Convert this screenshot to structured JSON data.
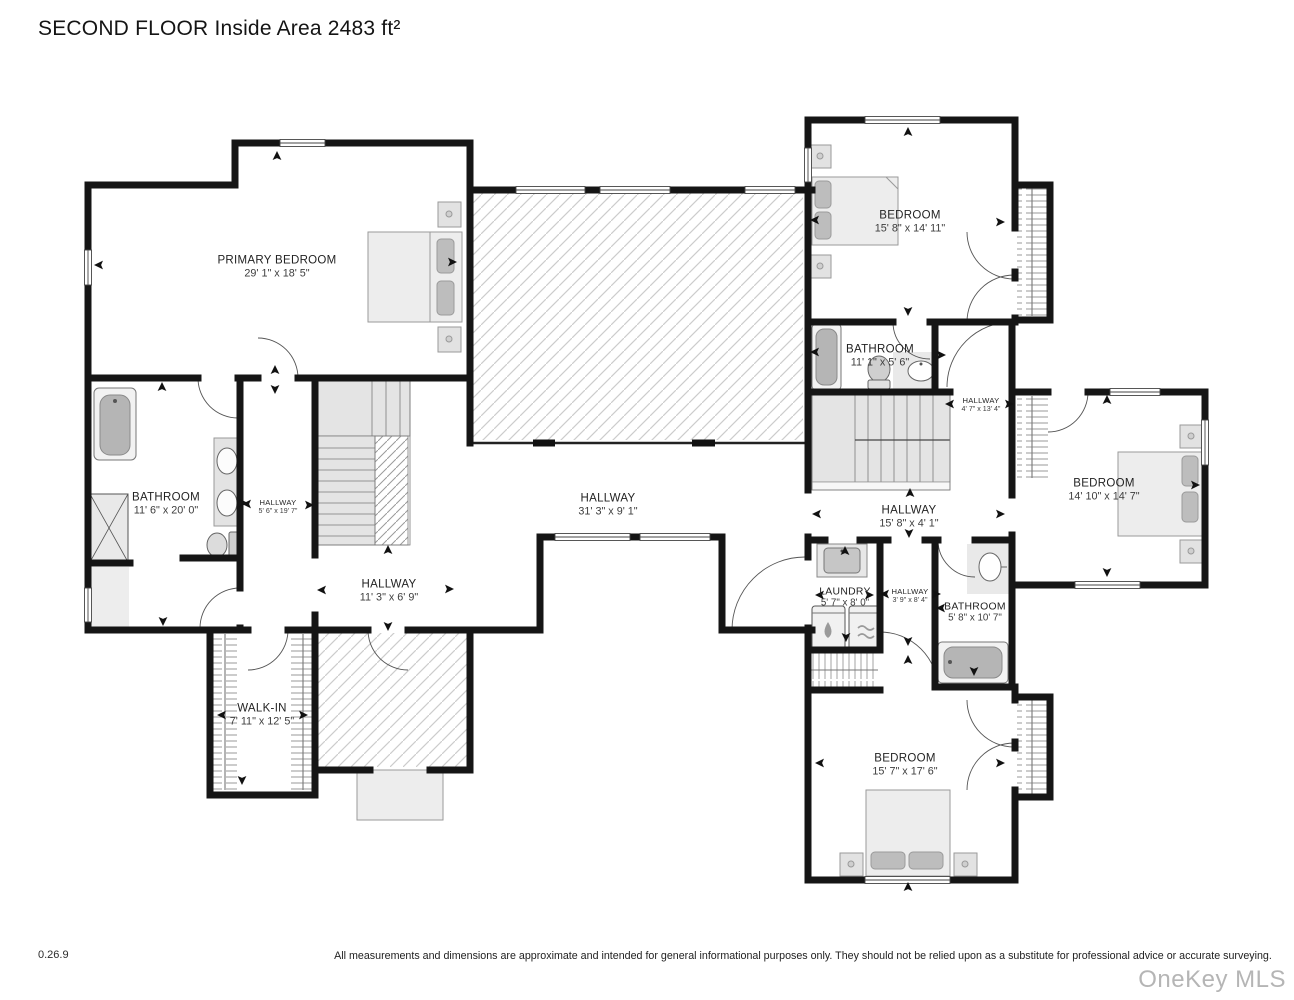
{
  "title": "SECOND FLOOR Inside Area 2483 ft²",
  "rooms": [
    {
      "name": "PRIMARY BEDROOM",
      "dims": "29' 1\" x 18' 5\""
    },
    {
      "name": "BEDROOM",
      "dims": "15' 8\" x 14' 11\""
    },
    {
      "name": "BATHROOM",
      "dims": "11' 1\" x 5' 6\""
    },
    {
      "name": "HALLWAY",
      "dims": "4' 7\" x 13' 4\""
    },
    {
      "name": "BEDROOM",
      "dims": "14' 10\" x 14' 7\""
    },
    {
      "name": "BATHROOM",
      "dims": "11' 6\" x 20' 0\""
    },
    {
      "name": "HALLWAY",
      "dims": "5' 6\" x 19' 7\""
    },
    {
      "name": "HALLWAY",
      "dims": "31' 3\" x 9' 1\""
    },
    {
      "name": "HALLWAY",
      "dims": "15' 8\" x 4' 1\""
    },
    {
      "name": "HALLWAY",
      "dims": "11' 3\" x 6' 9\""
    },
    {
      "name": "LAUNDRY",
      "dims": "5' 7\" x 8' 0\""
    },
    {
      "name": "HALLWAY",
      "dims": "3' 9\" x 8' 4\""
    },
    {
      "name": "BATHROOM",
      "dims": "5' 8\" x 10' 7\""
    },
    {
      "name": "WALK-IN",
      "dims": "7' 11\" x 12' 5\""
    },
    {
      "name": "BEDROOM",
      "dims": "15' 7\" x 17' 6\""
    }
  ],
  "footer": {
    "version": "0.26.9",
    "disclaimer": "All measurements and dimensions are approximate and intended for general informational purposes only. They should not be relied upon as a substitute for professional advice or accurate surveying.",
    "watermark": "OneKey MLS"
  },
  "colors": {
    "wall": "#151515",
    "hatch": "#cccccc",
    "watermark": "#b5b5b5"
  }
}
